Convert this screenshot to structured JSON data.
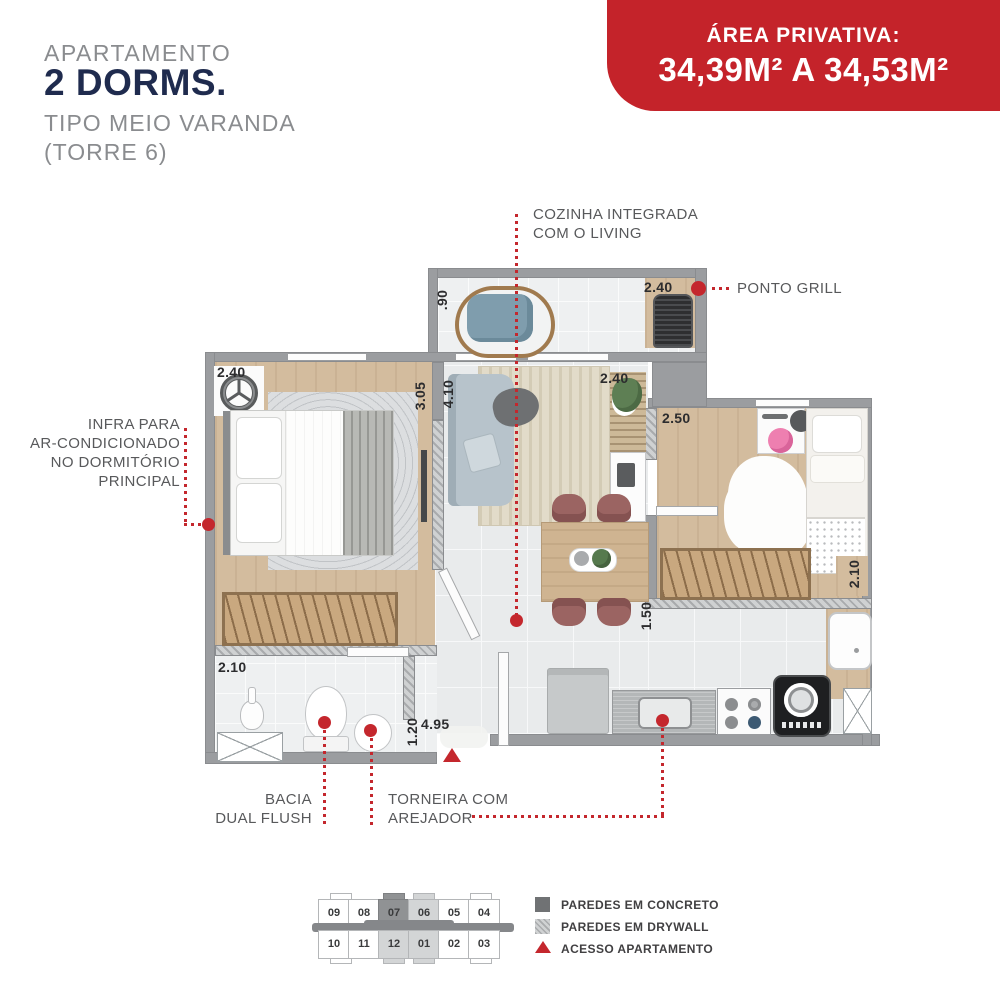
{
  "header": {
    "line1": "APARTAMENTO",
    "line2": "2 DORMS.",
    "line3": "TIPO MEIO VARANDA",
    "line4": "(TORRE 6)"
  },
  "area_banner": {
    "label": "ÁREA PRIVATIVA:",
    "value": "34,39M² A 34,53M²"
  },
  "callouts": {
    "cozinha_line1": "COZINHA INTEGRADA",
    "cozinha_line2": "COM O LIVING",
    "ponto_grill": "PONTO GRILL",
    "infra_line1": "INFRA PARA",
    "infra_line2": "AR-CONDICIONADO",
    "infra_line3": "NO DORMITÓRIO",
    "infra_line4": "PRINCIPAL",
    "bacia_line1": "BACIA",
    "bacia_line2": "DUAL FLUSH",
    "torneira_line1": "TORNEIRA COM",
    "torneira_line2": "AREJADOR"
  },
  "measurements": {
    "varanda_depth": ".90",
    "varanda_width": "2.40",
    "dorm1_width": "2.40",
    "dorm1_length": "3.05",
    "living_length": "4.10",
    "living_width": "2.40",
    "dorm2_width": "2.50",
    "dorm2_length": "2.10",
    "corridor": "1.50",
    "bath_width": "2.10",
    "bath_length": "1.20",
    "entry_span": "4.95"
  },
  "keyplan": {
    "row1": [
      "09",
      "08",
      "07",
      "06",
      "05",
      "04"
    ],
    "row2": [
      "10",
      "11",
      "12",
      "01",
      "02",
      "03"
    ],
    "highlight_dark": [
      "07"
    ],
    "highlight_light": [
      "06",
      "12",
      "01"
    ]
  },
  "legend": {
    "concrete": "PAREDES EM CONCRETO",
    "drywall": "PAREDES EM DRYWALL",
    "access": "ACESSO APARTAMENTO"
  },
  "colors": {
    "accent_red": "#c4232a",
    "brand_navy": "#1f2b4e",
    "wall_gray": "#9b9da0",
    "text_gray": "#8a8c8f"
  }
}
